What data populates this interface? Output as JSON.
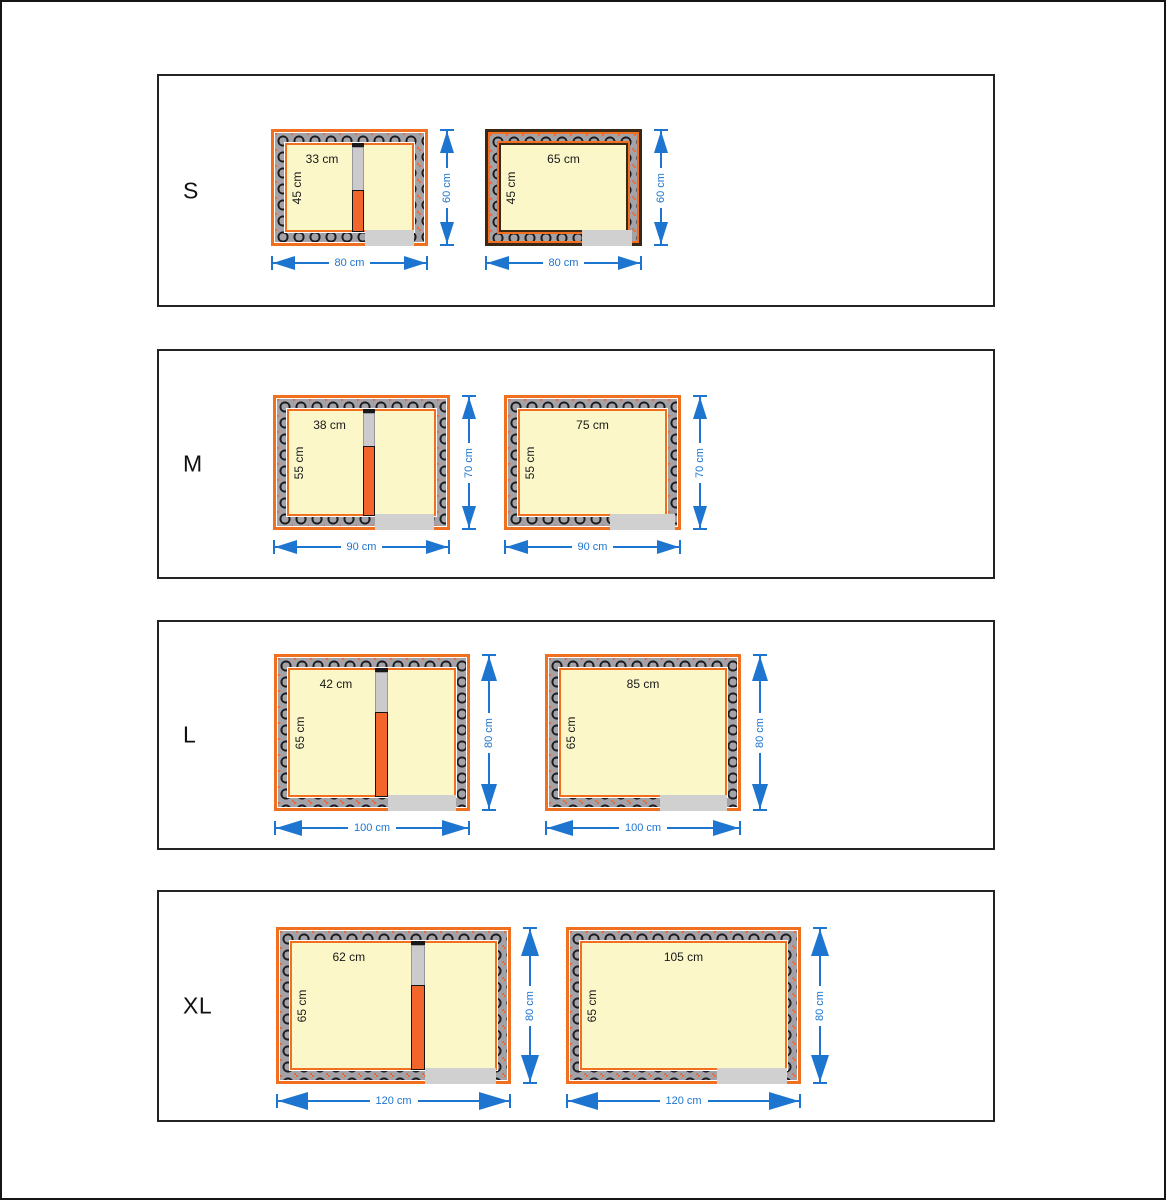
{
  "colors": {
    "orange": "#F07020",
    "divider_orange": "#F3662B",
    "brown": "#3A2817",
    "blue": "#1D75D0",
    "wall_gray": "#A2A2A8",
    "cream": "#FBF7C9",
    "door_gray": "#D0D0D0",
    "divider_gray": "#CBCBCE"
  },
  "rows": [
    {
      "label": "S",
      "plans": [
        {
          "room_width": "33 cm",
          "room_depth": "45 cm",
          "overall_width": "80 cm",
          "overall_height": "60 cm"
        },
        {
          "room_width": "65 cm",
          "room_depth": "45 cm",
          "overall_width": "80 cm",
          "overall_height": "60 cm"
        }
      ]
    },
    {
      "label": "M",
      "plans": [
        {
          "room_width": "38 cm",
          "room_depth": "55 cm",
          "overall_width": "90 cm",
          "overall_height": "70 cm"
        },
        {
          "room_width": "75 cm",
          "room_depth": "55 cm",
          "overall_width": "90 cm",
          "overall_height": "70 cm"
        }
      ]
    },
    {
      "label": "L",
      "plans": [
        {
          "room_width": "42 cm",
          "room_depth": "65 cm",
          "overall_width": "100 cm",
          "overall_height": "80 cm"
        },
        {
          "room_width": "85 cm",
          "room_depth": "65 cm",
          "overall_width": "100 cm",
          "overall_height": "80 cm"
        }
      ]
    },
    {
      "label": "XL",
      "plans": [
        {
          "room_width": "62 cm",
          "room_depth": "65 cm",
          "overall_width": "120 cm",
          "overall_height": "80 cm"
        },
        {
          "room_width": "105 cm",
          "room_depth": "65 cm",
          "overall_width": "120 cm",
          "overall_height": "80 cm"
        }
      ]
    }
  ]
}
